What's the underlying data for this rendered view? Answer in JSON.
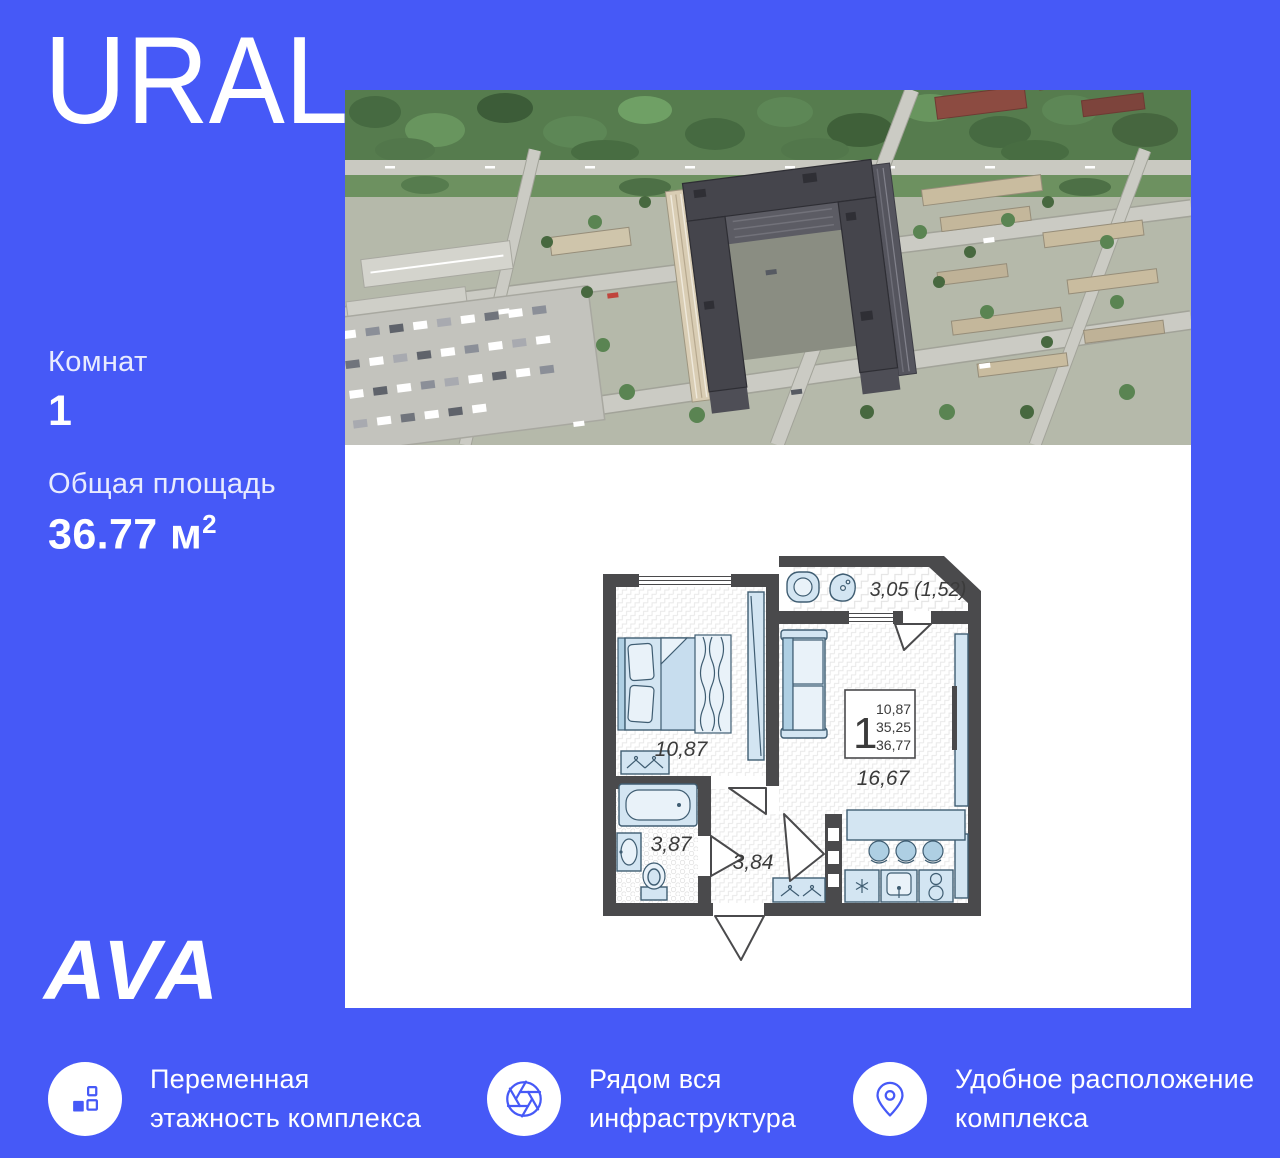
{
  "colors": {
    "background": "#4659f7",
    "accent": "#4659f7",
    "panel": "#ffffff",
    "plan_wall": "#4a4a4c",
    "plan_furniture": "#d3e5f2"
  },
  "title": "URAL",
  "stats": {
    "rooms_label": "Комнат",
    "rooms_value": "1",
    "area_label": "Общая площадь",
    "area_value": "36.77 м",
    "area_sup": "2"
  },
  "developer_logo": "AVA",
  "floor_plan": {
    "balcony_area": "3,05 (1,52)",
    "bedroom_area": "10,87",
    "living_area": "16,67",
    "bathroom_area": "3,87",
    "hall_area": "3,84",
    "info_box": {
      "rooms": "1",
      "living_area": "10,87",
      "area_no_balcony": "35,25",
      "total_area": "36,77"
    }
  },
  "features": [
    {
      "icon": "blocks-icon",
      "line1": "Переменная",
      "line2": "этажность комплекса"
    },
    {
      "icon": "aperture-icon",
      "line1": "Рядом вся",
      "line2": "инфраструктура"
    },
    {
      "icon": "location-pin-icon",
      "line1": "Удобное расположение",
      "line2": "комплекса"
    }
  ]
}
